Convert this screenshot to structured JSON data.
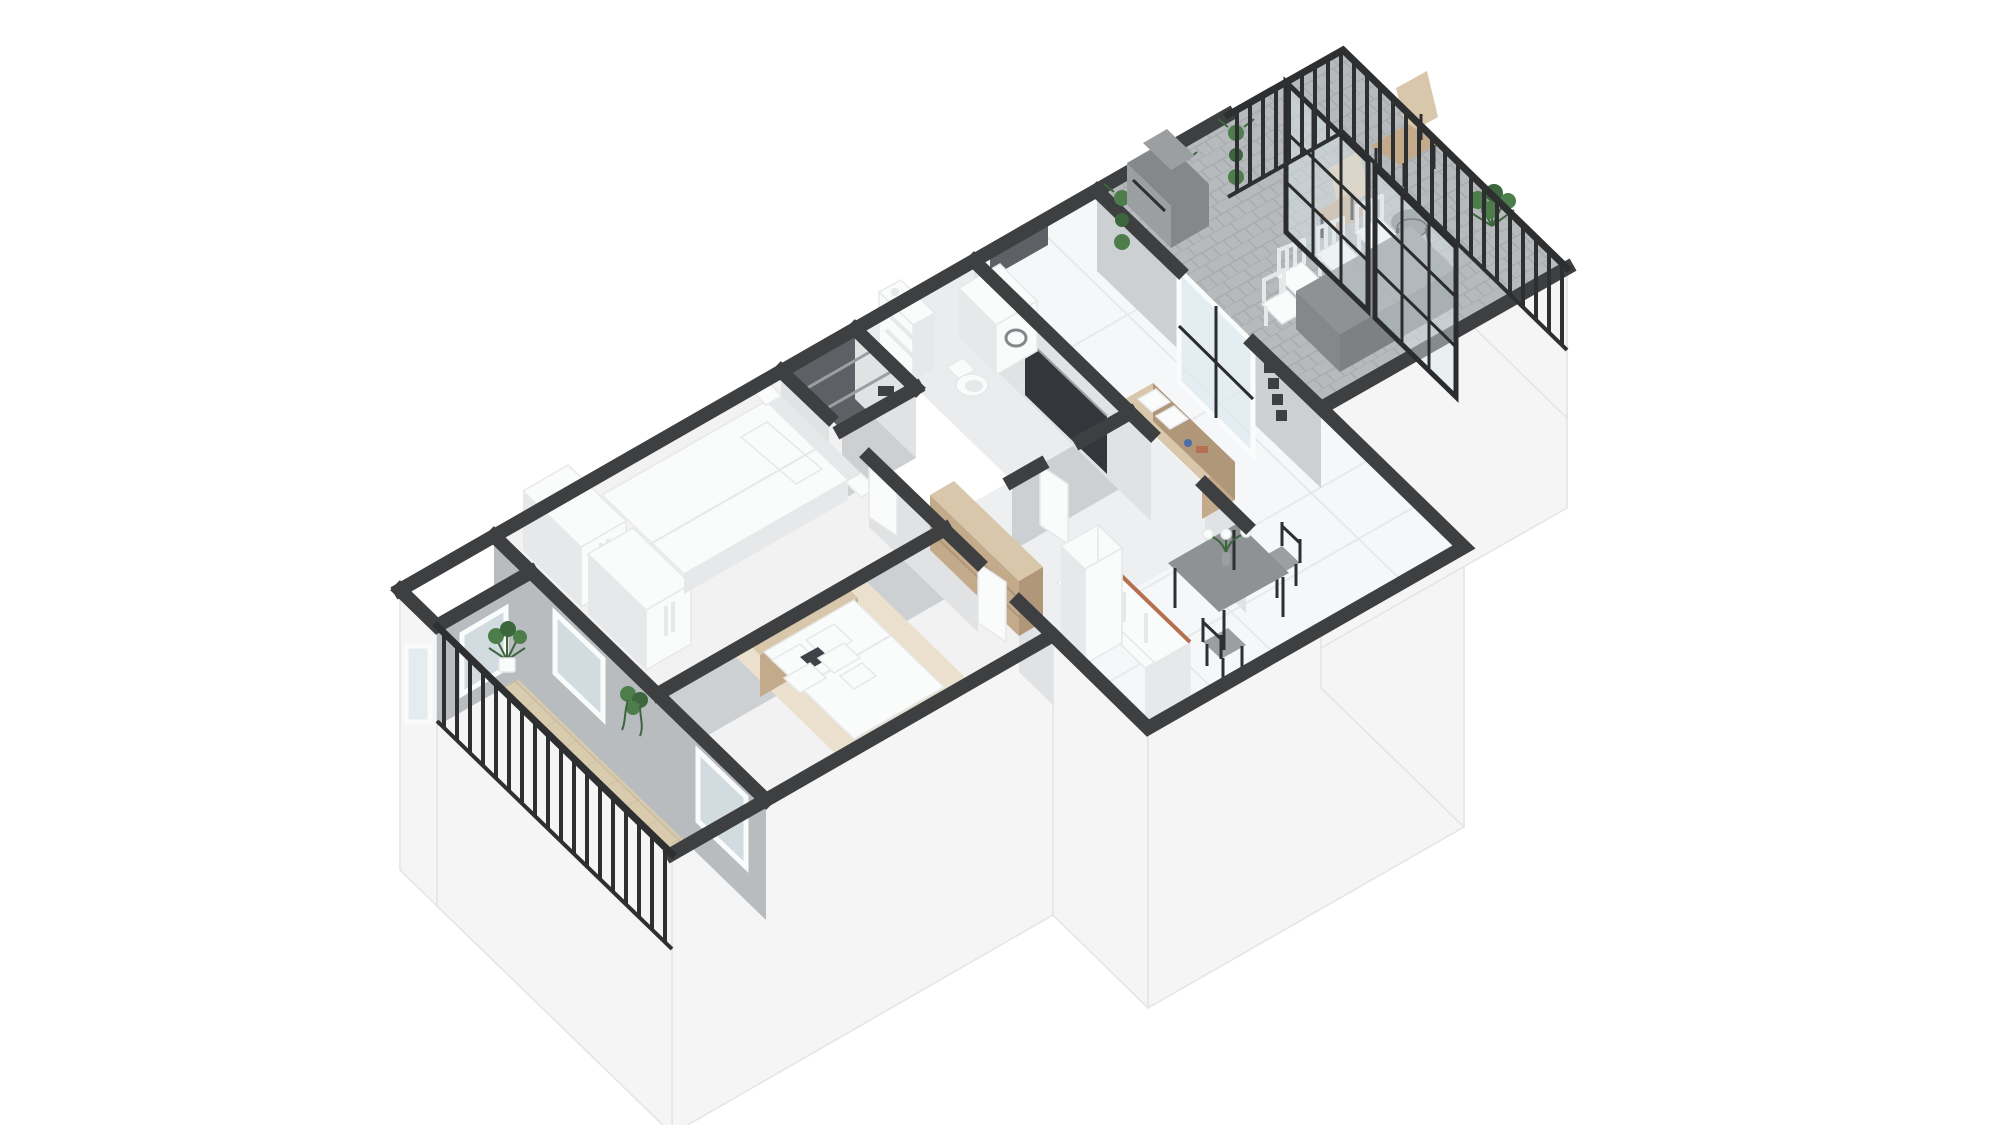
{
  "meta": {
    "title": "3D isometric floor plan render of an apartment (dollhouse top view)",
    "view": "isometric-top-down",
    "text_on_screen": "none"
  },
  "palette": {
    "background": "#ffffff",
    "wall_band": "#3e3f41",
    "wall_face_light": "#e0e2e4",
    "wall_face_mid": "#cdd0d2",
    "wall_face_dark": "#b9bcbf",
    "exterior_face": "#f5f5f6",
    "exterior_edge": "#e3e4e6",
    "floor_room": "#f2f2f3",
    "floor_hall": "#eeeff0",
    "floor_bath": "#ebecee",
    "floor_living": "#f6f7f8",
    "tile_line": "#e7e9eb",
    "floor_terrace": "#b7babc",
    "terrace_line": "#a8abad",
    "floor_balcony": "#d9cbae",
    "balcony_line": "#c9bb9e",
    "storage_dark": "#5d6064",
    "wood_light": "#d9c7ab",
    "wood_mid": "#c3aa8b",
    "wood_dark": "#b0977a",
    "copper": "#b5714f",
    "plant": "#4e7d4c",
    "plant_dark": "#3c663c",
    "rail_dark": "#2e2f31",
    "glass_frame": "#2b2c2e",
    "glass_fill": "#dde8ee",
    "tv_dark": "#33363a",
    "metal": "#85888b",
    "metal_light": "#9c9fa2",
    "table_gray": "#8f9295",
    "table_dark": "#7e8184",
    "white_obj": "#fafbfb",
    "white_shade": "#e6e8ea",
    "rug": "#eae0cd",
    "pillow_accent": "#3f4246"
  },
  "rooms": {
    "terrace": {
      "label": "Terrace with grey pavers, railing, glass partition, BBQ, outdoor dining table and chairs"
    },
    "living": {
      "label": "Living room and kitchen with wall TV, media console, dining table, french doors to terrace"
    },
    "bathroom": {
      "label": "Bathroom with washing machine, toilet and shelf unit"
    },
    "storage": {
      "label": "Dark storage closet with shelves"
    },
    "hallway": {
      "label": "Hallway with doors to bedrooms and bathroom"
    },
    "bedroom1": {
      "label": "Bedroom 1 with two wardrobes and a double bed"
    },
    "bedroom2": {
      "label": "Bedroom 2 with beige headboard bed, pillows, rug and shelving unit"
    },
    "balcony": {
      "label": "Wooden balcony with dark railing and plants"
    }
  },
  "furniture": {
    "terrace": [
      "bbq-grill",
      "wall-planter x3",
      "sling-chair",
      "lounge-chair",
      "bistro-table",
      "outdoor-dining-table",
      "white-chair x4",
      "glass-partition",
      "railing",
      "corner-plant"
    ],
    "living": [
      "wall-tv",
      "media-console",
      "cushions x2",
      "picture-frame x4",
      "dining-table",
      "flower-vase",
      "chair x2",
      "kitchen-cabinet",
      "tall-cabinet",
      "entrance-recess",
      "french-doors"
    ],
    "bathroom": [
      "washing-machine",
      "toilet",
      "shelf-unit",
      "wall-mirror"
    ],
    "hallway": [
      "door-leaf x2"
    ],
    "bedroom1": [
      "wardrobe x2",
      "double-bed",
      "pillow",
      "headboard-niche"
    ],
    "bedroom2": [
      "double-bed",
      "pillow x6",
      "area-rug",
      "shelving-unit",
      "door-leaf"
    ],
    "balcony": [
      "potted-plant",
      "hanging-plant",
      "window",
      "balcony-door",
      "railing"
    ]
  }
}
